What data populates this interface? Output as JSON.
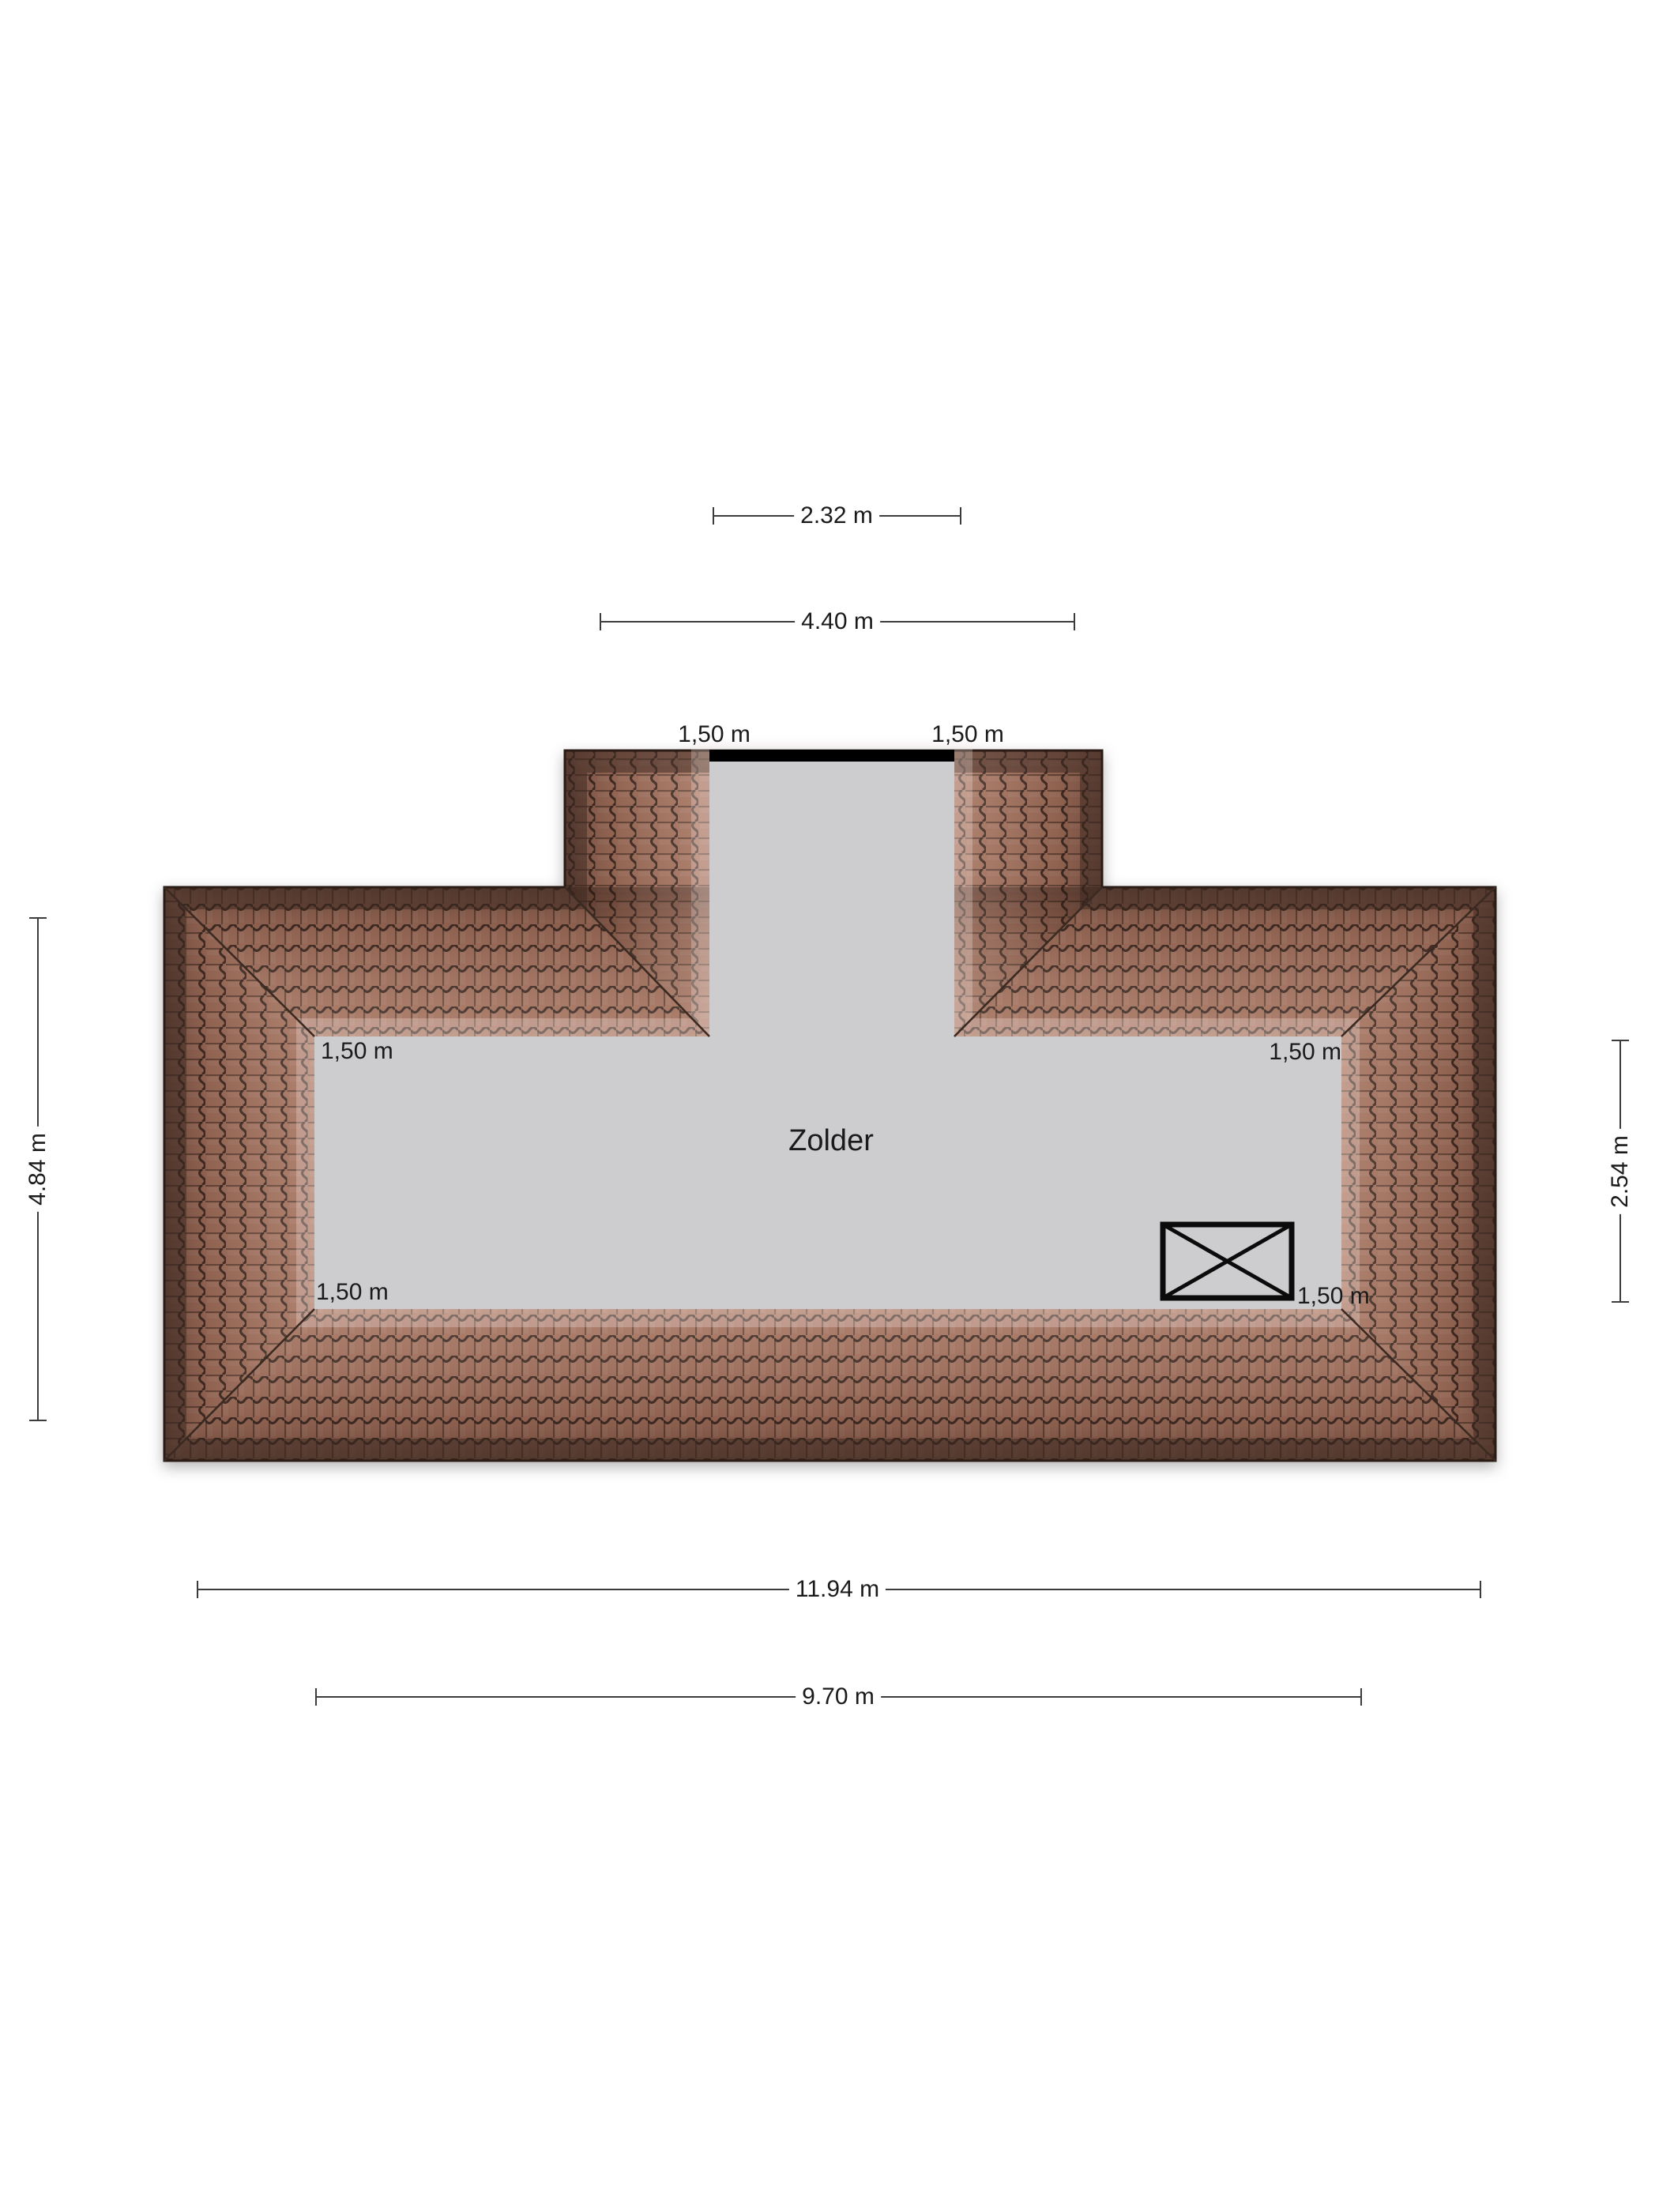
{
  "room": {
    "label": "Zolder"
  },
  "dimensions": {
    "dormer_inner_width": "2.32 m",
    "dormer_outer_width": "4.40 m",
    "house_depth": "4.84 m",
    "attic_floor_depth": "2.54 m",
    "house_width": "11.94 m",
    "attic_floor_width": "9.70 m",
    "dormer_left_knee": "1,50 m",
    "dormer_right_knee": "1,50 m",
    "interior_top_left_knee": "1,50 m",
    "interior_top_right_knee": "1,50 m",
    "interior_bottom_left_knee": "1,50 m",
    "interior_bottom_right_knee": "1,50 m"
  },
  "symbols": {
    "skylight": "crossed-rectangle-roof-window"
  },
  "colors": {
    "roof_tile_base": "#a3715e",
    "roof_joint_dark": "#33241d",
    "roof_eave_shadow": "#3d2a22",
    "floor_gray": "#cdcdcf",
    "dormer_front_wall": "#000000",
    "dimension_line": "#3c3c3c",
    "text": "#1a1a1a",
    "background": "#ffffff"
  }
}
